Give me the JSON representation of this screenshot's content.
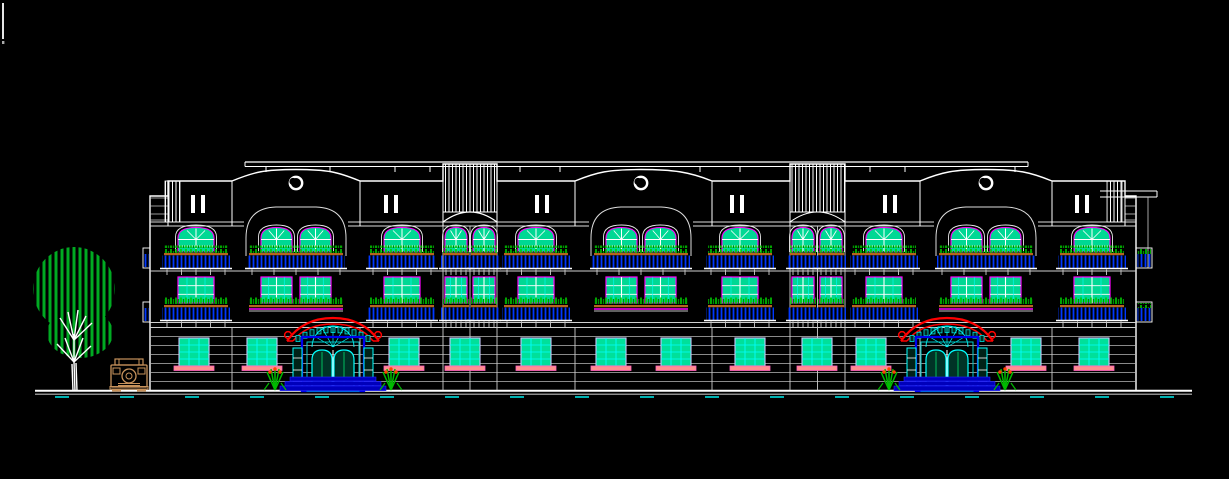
{
  "meta": {
    "description": "CAD front elevation drawing of a 3-storey apartment building with tree and car entourage"
  },
  "canvas": {
    "width": 1229,
    "height": 479,
    "background": "#000000"
  },
  "colors": {
    "outline": "#ffffff",
    "soft_outline": "#cccccc",
    "frame_magenta": "#ff00ff",
    "glass": "#00d894",
    "glass_ground": "#00e09a",
    "grid_cyan": "#00ffff",
    "ground_frame": "#c8c8ff",
    "plant_green": "#00cc00",
    "plant_dark": "#008f00",
    "railing_blue": "#0038ff",
    "planter_tan": "#b5651d",
    "sill_pink": "#ff8f8f",
    "sill_edge": "#ff5fbf",
    "canopy_red": "#ff0000",
    "door_blue": "#0000ee",
    "step_blue": "#0000bb",
    "door_glass": "#003326",
    "flower_orange": "#ff4400",
    "tree_green": "#00aa22",
    "car_tan": "#c8935c",
    "tick_cyan": "#00ffff"
  },
  "cursor": {
    "x": 3,
    "y1": 3,
    "y2": 39,
    "dot_y": 41
  },
  "ground": {
    "x1": 35,
    "x2": 1192,
    "y1": 390.8,
    "y2": 394.2,
    "tick_y": 397,
    "tick_start": 55,
    "tick_step": 65,
    "tick_w": 14,
    "tick_count": 18
  },
  "building": {
    "left": 150,
    "right": 1136,
    "bottom": 391,
    "top_flat": 181,
    "wing_top": 196,
    "roof_band": {
      "x1": 245,
      "x2": 1028,
      "y1": 162,
      "y2": 166.5,
      "ticks": [
        266,
        330,
        395,
        430,
        520,
        560,
        700,
        740,
        870,
        905,
        1015
      ]
    },
    "blocks": [
      [
        168,
        232
      ],
      [
        360,
        443
      ],
      [
        497,
        575
      ],
      [
        712,
        790
      ],
      [
        845,
        920
      ],
      [
        1052,
        1125
      ]
    ],
    "gables": [
      {
        "x1": 232,
        "x2": 360,
        "cx": 296
      },
      {
        "x1": 575,
        "x2": 712,
        "cx": 641
      },
      {
        "x1": 920,
        "x2": 1052,
        "cx": 986
      }
    ],
    "gable_peak_y": 169.5,
    "towers": [
      {
        "x1": 443,
        "x2": 497
      },
      {
        "x1": 790,
        "x2": 845
      }
    ],
    "tower_top": 164,
    "tower_stripe_bottom": 212,
    "tower_arch_y": 222,
    "pilasters": [
      [
        165,
        15
      ],
      [
        1107,
        15
      ]
    ],
    "ii_marks": {
      "cx": [
        198,
        391,
        542,
        737,
        890,
        1082
      ],
      "y": 195,
      "h": 18
    },
    "circles": {
      "cx": [
        296,
        641,
        986
      ],
      "cy": 183,
      "r": 6.2
    },
    "cornice_ys": [
      222,
      226
    ],
    "cornice_segments": [
      [
        150,
        244
      ],
      [
        348,
        589
      ],
      [
        693,
        934
      ],
      [
        1038,
        1136
      ]
    ],
    "wing_line_ys": [
      198,
      206,
      214,
      220
    ],
    "floor_line_ys": [
      271,
      322.5,
      327.5
    ],
    "siding_ys": [
      336.5,
      345.5,
      354.5,
      363.5,
      372.5,
      381.5
    ],
    "joints": [
      232,
      360,
      575,
      712,
      920,
      1052
    ],
    "right_cornice": {
      "x1": 1100,
      "x2": 1157,
      "y1": 191,
      "y2": 197
    }
  },
  "floor3": {
    "win_top": 227.5,
    "win_bottom": 252,
    "planter_y": 252,
    "units": [
      {
        "cx": 196,
        "type": "arch-single"
      },
      {
        "cx": 296,
        "type": "arch-pair"
      },
      {
        "cx": 402,
        "type": "arch-single"
      },
      {
        "cx": 456,
        "type": "arch-narrow"
      },
      {
        "cx": 484,
        "type": "arch-narrow"
      },
      {
        "cx": 536,
        "type": "arch-single"
      },
      {
        "cx": 641,
        "type": "arch-pair"
      },
      {
        "cx": 740,
        "type": "arch-single"
      },
      {
        "cx": 803,
        "type": "arch-narrow"
      },
      {
        "cx": 831,
        "type": "arch-narrow"
      },
      {
        "cx": 884,
        "type": "arch-single"
      },
      {
        "cx": 986,
        "type": "arch-pair"
      },
      {
        "cx": 1092,
        "type": "arch-single"
      }
    ]
  },
  "floor2": {
    "win_top": 277,
    "win_bottom": 303,
    "planter_y": 304,
    "units": [
      {
        "cx": 196,
        "type": "rect-single"
      },
      {
        "cx": 296,
        "type": "rect-pair"
      },
      {
        "cx": 402,
        "type": "rect-single"
      },
      {
        "cx": 456,
        "type": "rect-narrow"
      },
      {
        "cx": 484,
        "type": "rect-narrow"
      },
      {
        "cx": 536,
        "type": "rect-single"
      },
      {
        "cx": 641,
        "type": "rect-pair"
      },
      {
        "cx": 740,
        "type": "rect-single"
      },
      {
        "cx": 803,
        "type": "rect-narrow"
      },
      {
        "cx": 831,
        "type": "rect-narrow"
      },
      {
        "cx": 884,
        "type": "rect-single"
      },
      {
        "cx": 986,
        "type": "rect-pair"
      },
      {
        "cx": 1092,
        "type": "rect-single"
      }
    ]
  },
  "ground_floor": {
    "win_top": 338,
    "win_h": 28,
    "win_w": 30,
    "sill_y": 366,
    "window_cx": [
      194,
      262,
      404,
      465,
      536,
      611,
      676,
      750,
      817,
      871,
      1026,
      1094
    ]
  },
  "entrances": {
    "cx": [
      333,
      947
    ],
    "canopy_top": 318,
    "door_top": 337,
    "door_w": 62,
    "bottom": 391
  },
  "widths": {
    "single_win": 36,
    "narrow_win": 22,
    "pair_win": 31,
    "single_balcony": 64,
    "narrow_balcony": 26,
    "pair_balcony": 94
  },
  "side_balconies": {
    "right": [
      {
        "x": 1136,
        "y": 248
      },
      {
        "x": 1136,
        "y": 302
      }
    ],
    "left": [
      {
        "x": 143,
        "y": 248
      },
      {
        "x": 143,
        "y": 302
      }
    ],
    "w": 16,
    "h": 20
  },
  "tree": {
    "canopy": [
      {
        "cx": 74,
        "cy": 289,
        "rx": 41,
        "ry": 42
      },
      {
        "cx": 80,
        "cy": 333,
        "rx": 33,
        "ry": 25
      }
    ],
    "branches": [
      "75,391 74,362",
      "73,391 72,364",
      "77,391 76,363",
      "74,362 57,344",
      "74,362 65,338",
      "74,362 74,334",
      "74,362 83,338",
      "74,362 91,346",
      "74,340 60,318",
      "74,340 68,312",
      "74,340 78,310",
      "74,340 86,316",
      "74,340 92,323"
    ]
  },
  "car": {
    "x": 110,
    "y": 358,
    "w": 38,
    "h": 34
  }
}
